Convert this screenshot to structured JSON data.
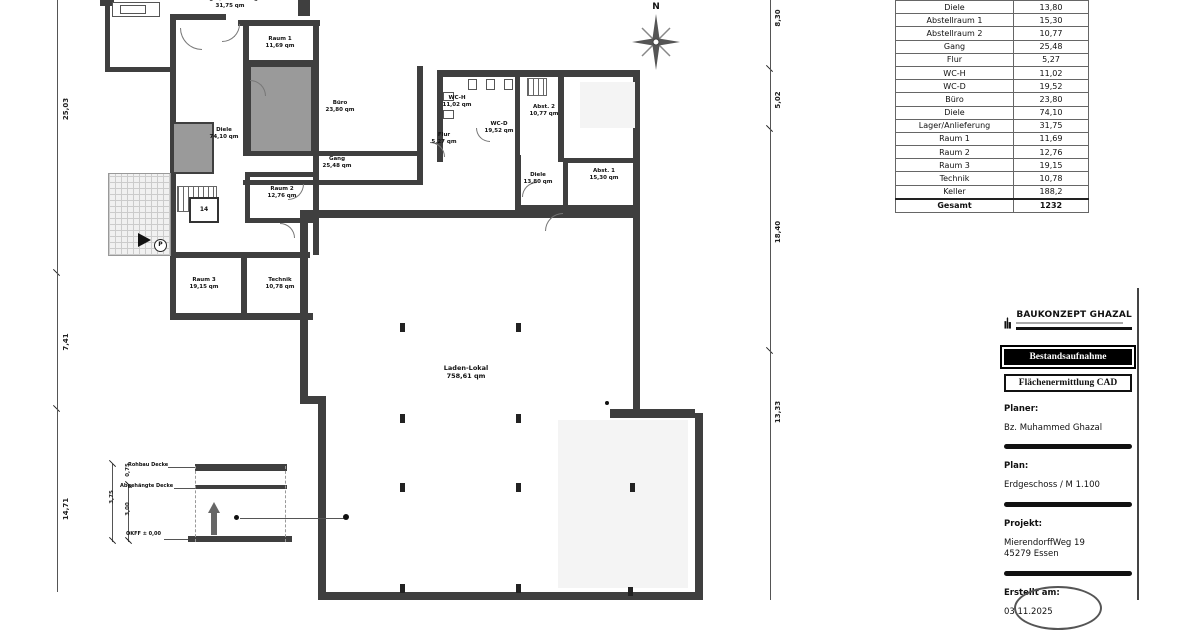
{
  "sheet": {
    "north_label": "N"
  },
  "plan": {
    "rooms": [
      {
        "name": "Lager/Anlieferung",
        "area": "31,75 qm"
      },
      {
        "name": "Raum 1",
        "area": "11,69 qm"
      },
      {
        "name": "Büro",
        "area": "23,80 qm"
      },
      {
        "name": "Diele",
        "area": "74,10 qm"
      },
      {
        "name": "Gang",
        "area": "25,48 qm"
      },
      {
        "name": "WC-H",
        "area": "11,02 qm"
      },
      {
        "name": "WC-D",
        "area": "19,52 qm"
      },
      {
        "name": "Abst. 2",
        "area": "10,77 qm"
      },
      {
        "name": "Flur",
        "area": "5,27 qm"
      },
      {
        "name": "Diele",
        "area": "13,80 qm"
      },
      {
        "name": "Abst. 1",
        "area": "15,30 qm"
      },
      {
        "name": "Raum 2",
        "area": "12,76 qm"
      },
      {
        "name": "Raum 3",
        "area": "19,15 qm"
      },
      {
        "name": "Technik",
        "area": "10,78 qm"
      },
      {
        "name": "Laden-Lokal",
        "area": "758,61 qm"
      }
    ],
    "elevator_label": "14",
    "parking_label": "P"
  },
  "dimensions": {
    "left": [
      "25,03",
      "7,41",
      "14,71"
    ],
    "right": [
      "8,30",
      "5,02",
      "18,40",
      "13,33"
    ]
  },
  "detail": {
    "rohbau_label": "Rohbau Decke",
    "abgehaengt_label": "Abgehängte Decke",
    "okff_label": "OKFF ± 0,00",
    "dim_total": "3,75",
    "dim_room": "3,00",
    "dim_ceiling": "0,75"
  },
  "area_table": {
    "rows": [
      [
        "Diele",
        "13,80"
      ],
      [
        "Abstellraum 1",
        "15,30"
      ],
      [
        "Abstellraum 2",
        "10,77"
      ],
      [
        "Gang",
        "25,48"
      ],
      [
        "Flur",
        "5,27"
      ],
      [
        "WC-H",
        "11,02"
      ],
      [
        "WC-D",
        "19,52"
      ],
      [
        "Büro",
        "23,80"
      ],
      [
        "Diele",
        "74,10"
      ],
      [
        "Lager/Anlieferung",
        "31,75"
      ],
      [
        "Raum 1",
        "11,69"
      ],
      [
        "Raum 2",
        "12,76"
      ],
      [
        "Raum 3",
        "19,15"
      ],
      [
        "Technik",
        "10,78"
      ],
      [
        "Keller",
        "188,2"
      ],
      [
        "Gesamt",
        "1232"
      ]
    ]
  },
  "title_block": {
    "brand": "BAUKONZEPT GHAZAL",
    "doc_type": "Bestandsaufnahme",
    "doc_subtype": "Flächenermittlung CAD",
    "planer_label": "Planer:",
    "planer": "Bz. Muhammed Ghazal",
    "plan_label": "Plan:",
    "plan": "Erdgeschoss / M 1.100",
    "projekt_label": "Projekt:",
    "projekt_address": "MierendorffWeg 19",
    "projekt_city": "45279 Essen",
    "created_label": "Erstellt am:",
    "created": "03.11.2025"
  }
}
